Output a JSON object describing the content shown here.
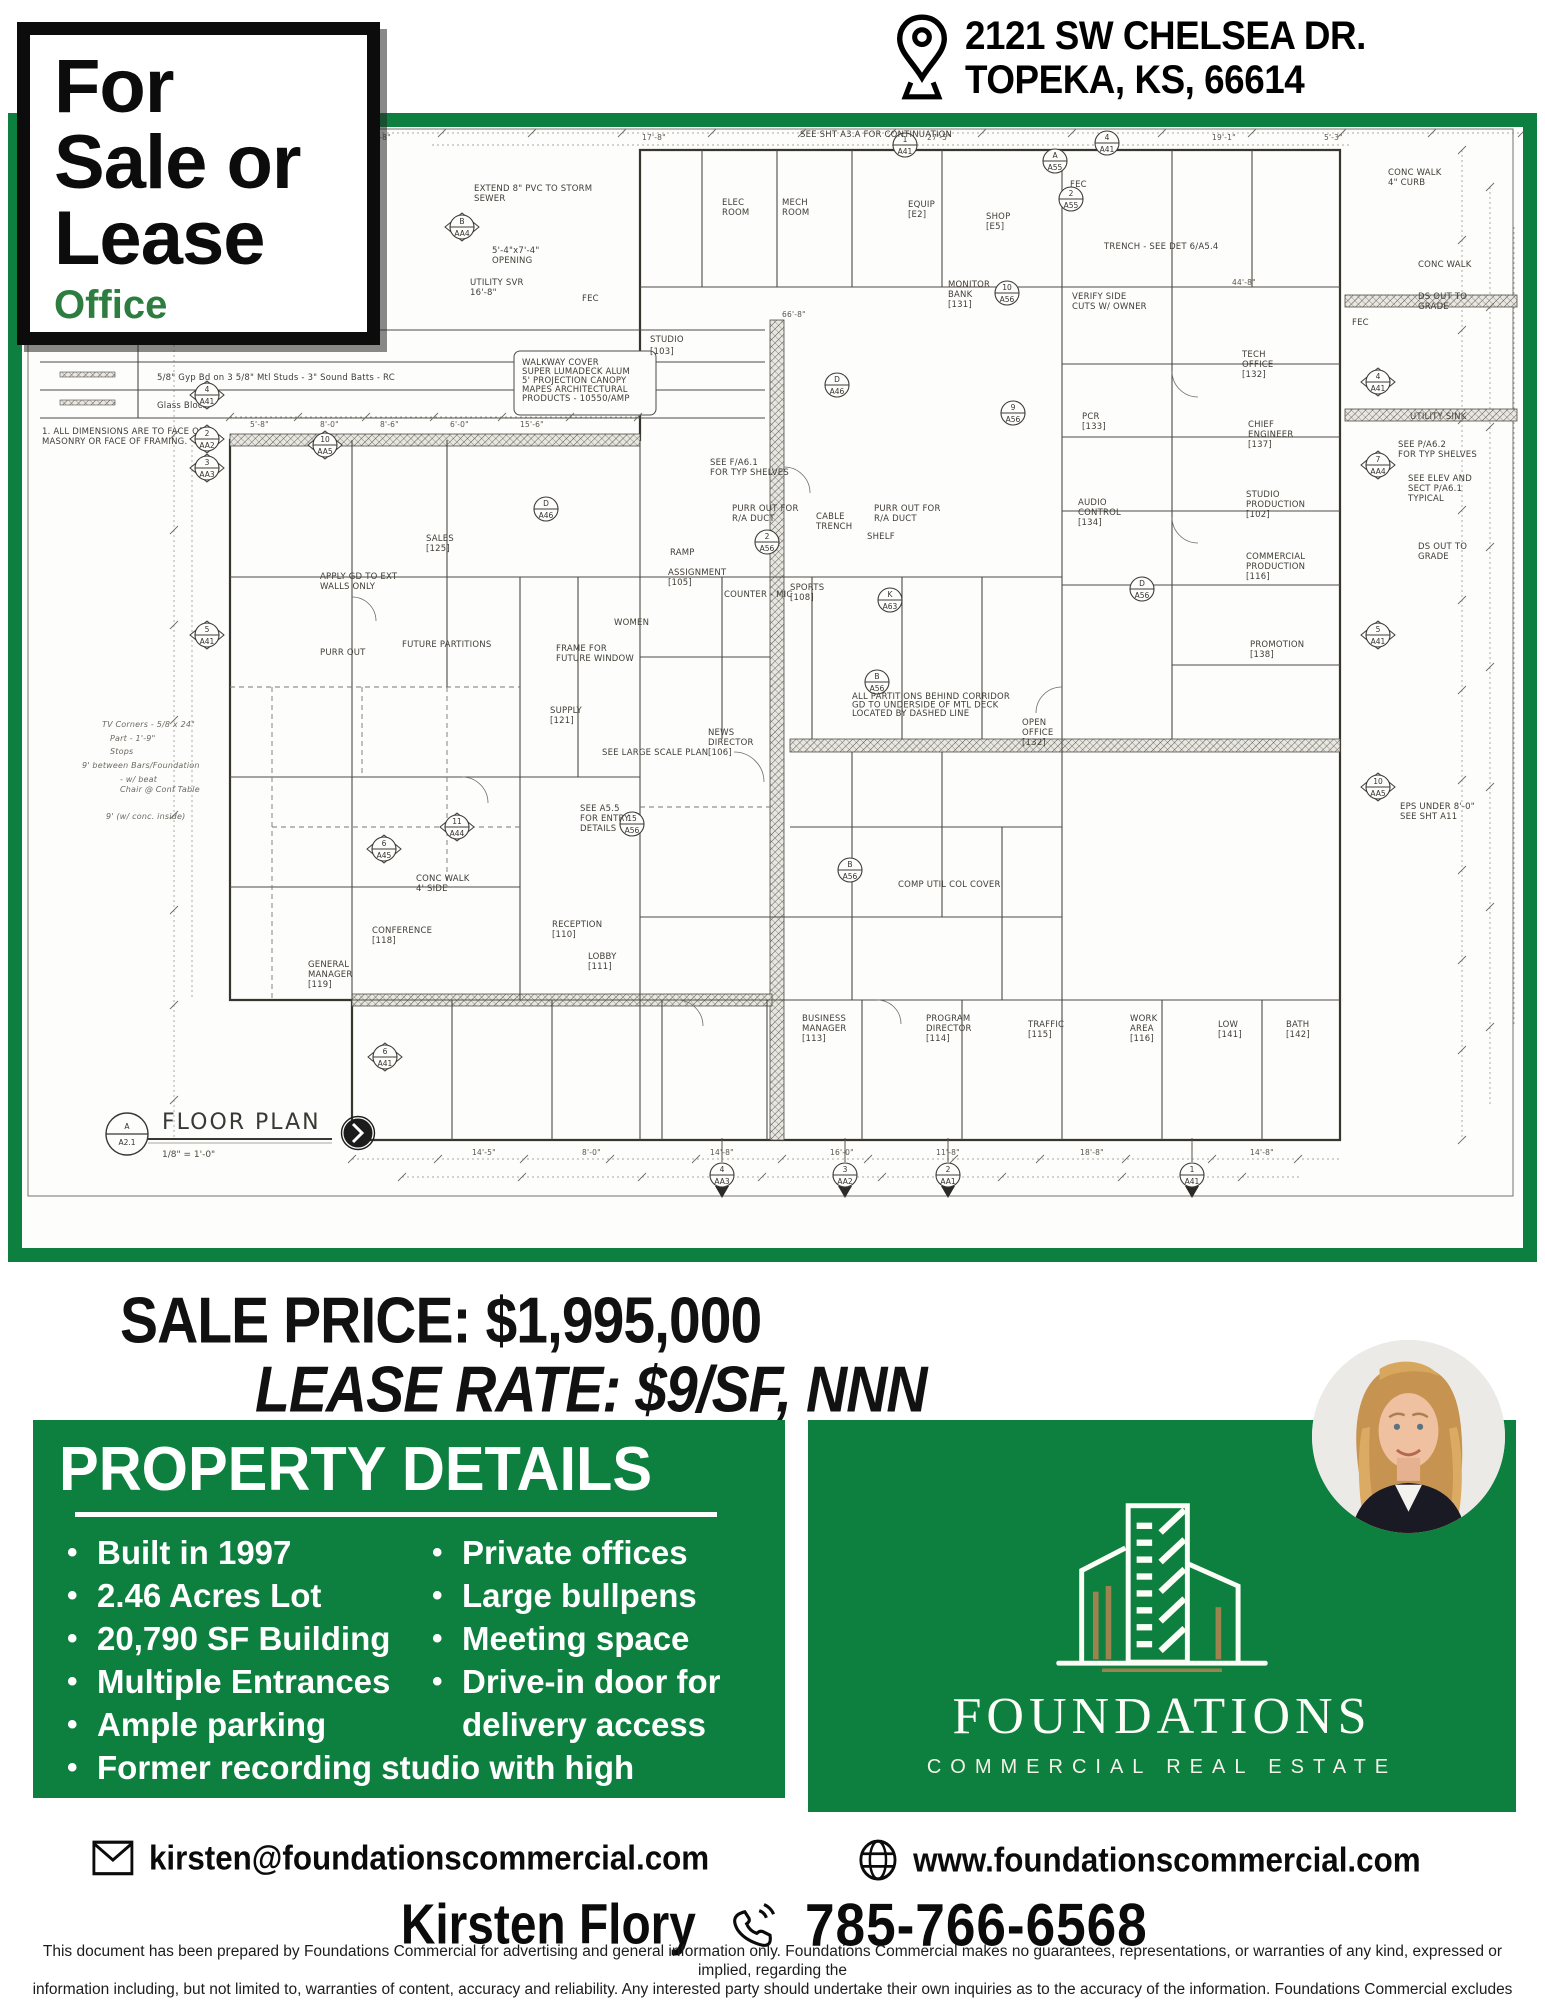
{
  "address": {
    "line1": "2121 SW CHELSEA DR.",
    "line2": "TOPEKA, KS, 66614"
  },
  "banner": {
    "line1": "For",
    "line2": "Sale or",
    "line3": "Lease",
    "subtitle": "Office"
  },
  "pricing": {
    "sale": "SALE PRICE: $1,995,000",
    "lease": "LEASE RATE: $9/SF, NNN"
  },
  "property_details": {
    "title": "PROPERTY DETAILS",
    "column1": [
      "Built in 1997",
      "2.46 Acres Lot",
      "20,790 SF Building",
      "Multiple Entrances",
      "Ample parking"
    ],
    "column2": [
      "Private offices",
      "Large bullpens",
      "Meeting space",
      "Drive-in door for delivery access"
    ],
    "full_width": [
      "Former recording studio with high ceilings"
    ]
  },
  "brand": {
    "name": "FOUNDATIONS",
    "tagline": "COMMERCIAL REAL ESTATE"
  },
  "contact": {
    "email": "kirsten@foundationscommercial.com",
    "website": "www.foundationscommercial.com",
    "agent": "Kirsten Flory",
    "phone": "785-766-6568"
  },
  "colors": {
    "green": "#0d7f3e",
    "office_green": "#2e7d40",
    "gold": "#9d8350"
  },
  "disclaimer": [
    "This document has been prepared by Foundations Commercial for advertising and general information only.  Foundations Commercial makes no guarantees, representations, or warranties of any kind, expressed or implied, regarding the",
    "information including, but not limited to, warranties of content, accuracy and reliability.  Any interested party should undertake their own inquiries as to the accuracy of the information.  Foundations Commercial excludes unequivocally all",
    "inferred or implied terms, conditions and warranties arising out of this document and excludes all liability for loss and damages arising there from.  This communication is not intended to cause or induce of any existing listing agreement."
  ],
  "plan": {
    "title": "FLOOR PLAN",
    "scale": "1/8\" = 1'-0\"",
    "ref_top": "A",
    "ref_bot": "A2.1",
    "legend1": "5/8\" Gyp Bd on 3 5/8\" Mtl Studs - 3\" Sound Batts - RC",
    "legend2": "Glass Block",
    "note1": "1. ALL DIMENSIONS ARE TO FACE OF",
    "note2": "MASONRY OR FACE OF FRAMING.",
    "labels": [
      {
        "t": "SEE SHT A3.A FOR CONTINUATION",
        "x": 778,
        "y": 10
      },
      {
        "t": "EXTEND 8\" PVC TO STORM\nSEWER",
        "x": 452,
        "y": 64
      },
      {
        "t": "CONC WALK\n4\" CURB",
        "x": 1366,
        "y": 48
      },
      {
        "t": "TRENCH - SEE DET 6/A5.4",
        "x": 1082,
        "y": 122
      },
      {
        "t": "5'-4\"x7'-4\"\nOPENING",
        "x": 470,
        "y": 126
      },
      {
        "t": "UTILITY SVR\n16'-8\"",
        "x": 448,
        "y": 158
      },
      {
        "t": "FEC",
        "x": 560,
        "y": 174
      },
      {
        "t": "FEC",
        "x": 1048,
        "y": 60
      },
      {
        "t": "FEC",
        "x": 1330,
        "y": 198
      },
      {
        "t": "ELEC\nROOM",
        "x": 700,
        "y": 78
      },
      {
        "t": "MECH\nROOM",
        "x": 760,
        "y": 78
      },
      {
        "t": "EQUIP\n[E2]",
        "x": 886,
        "y": 80
      },
      {
        "t": "SHOP\n[E5]",
        "x": 964,
        "y": 92
      },
      {
        "t": "VERIFY SIDE\nCUTS W/ OWNER",
        "x": 1050,
        "y": 172
      },
      {
        "t": "MONITOR\nBANK\n[131]",
        "x": 926,
        "y": 160
      },
      {
        "t": "TECH\nOFFICE\n[132]",
        "x": 1220,
        "y": 230
      },
      {
        "t": "STUDIO\n[103]",
        "x": 628,
        "y": 215,
        "s": 10.5
      },
      {
        "t": "PCR\n[133]",
        "x": 1060,
        "y": 292
      },
      {
        "t": "CHIEF\nENGINEER\n[137]",
        "x": 1226,
        "y": 300
      },
      {
        "t": "AUDIO\nCONTROL\n[134]",
        "x": 1056,
        "y": 378
      },
      {
        "t": "STUDIO\nPRODUCTION\n[102]",
        "x": 1224,
        "y": 370
      },
      {
        "t": "COMMERCIAL\nPRODUCTION\n[116]",
        "x": 1224,
        "y": 432
      },
      {
        "t": "PROMOTION\n[138]",
        "x": 1228,
        "y": 520
      },
      {
        "t": "CONC WALK",
        "x": 1396,
        "y": 140
      },
      {
        "t": "DS OUT TO\nGRADE",
        "x": 1396,
        "y": 172
      },
      {
        "t": "UTILITY SINK",
        "x": 1388,
        "y": 292
      },
      {
        "t": "SEE P/A6.2\nFOR TYP SHELVES",
        "x": 1376,
        "y": 320
      },
      {
        "t": "SEE ELEV AND\nSECT P/A6.1\nTYPICAL",
        "x": 1386,
        "y": 354
      },
      {
        "t": "DS OUT TO\nGRADE",
        "x": 1396,
        "y": 422
      },
      {
        "t": "EPS UNDER 8'-0\"\nSEE SHT A11",
        "x": 1378,
        "y": 682
      },
      {
        "t": "PURR OUT FOR\nR/A DUCT",
        "x": 710,
        "y": 384
      },
      {
        "t": "CABLE\nTRENCH",
        "x": 794,
        "y": 392
      },
      {
        "t": "PURR OUT FOR\nR/A DUCT",
        "x": 852,
        "y": 384
      },
      {
        "t": "SEE F/A6.1\nFOR TYP SHELVES",
        "x": 688,
        "y": 338
      },
      {
        "t": "RAMP",
        "x": 648,
        "y": 428
      },
      {
        "t": "ASSIGNMENT\n[105]",
        "x": 646,
        "y": 448
      },
      {
        "t": "COUNTER - MIC",
        "x": 702,
        "y": 470
      },
      {
        "t": "SPORTS\n[108]",
        "x": 768,
        "y": 463
      },
      {
        "t": "SHELF",
        "x": 845,
        "y": 412
      },
      {
        "t": "NEWS\nDIRECTOR\n[106]",
        "x": 686,
        "y": 608
      },
      {
        "t": "WOMEN",
        "x": 592,
        "y": 498
      },
      {
        "t": "SALES\n[125]",
        "x": 404,
        "y": 414
      },
      {
        "t": "APPLY GD TO EXT\nWALLS ONLY",
        "x": 298,
        "y": 452
      },
      {
        "t": "FUTURE PARTITIONS",
        "x": 380,
        "y": 520
      },
      {
        "t": "PURR OUT",
        "x": 298,
        "y": 528
      },
      {
        "t": "FRAME FOR\nFUTURE WINDOW",
        "x": 534,
        "y": 524
      },
      {
        "t": "SUPPLY\n[121]",
        "x": 528,
        "y": 586
      },
      {
        "t": "SEE LARGE SCALE PLAN",
        "x": 580,
        "y": 628
      },
      {
        "t": "SEE A5.5\nFOR ENTRY\nDETAILS",
        "x": 558,
        "y": 684
      },
      {
        "t": "RECEPTION\n[110]",
        "x": 530,
        "y": 800
      },
      {
        "t": "LOBBY\n[111]",
        "x": 566,
        "y": 832
      },
      {
        "t": "CONFERENCE\n[118]",
        "x": 350,
        "y": 806
      },
      {
        "t": "GENERAL\nMANAGER\n[119]",
        "x": 286,
        "y": 840
      },
      {
        "t": "OPEN\nOFFICE\n[132]",
        "x": 1000,
        "y": 598
      },
      {
        "t": "BUSINESS\nMANAGER\n[113]",
        "x": 780,
        "y": 894
      },
      {
        "t": "PROGRAM\nDIRECTOR\n[114]",
        "x": 904,
        "y": 894
      },
      {
        "t": "TRAFFIC\n[115]",
        "x": 1006,
        "y": 900
      },
      {
        "t": "WORK\nAREA\n[116]",
        "x": 1108,
        "y": 894
      },
      {
        "t": "LOW\n[141]",
        "x": 1196,
        "y": 900
      },
      {
        "t": "BATH\n[142]",
        "x": 1264,
        "y": 900
      },
      {
        "t": "CONC WALK\n4' SIDE",
        "x": 394,
        "y": 754
      },
      {
        "t": "COMP UTIL COL COVER",
        "x": 876,
        "y": 760
      },
      {
        "t": "ALL PARTITIONS BEHIND CORRIDOR\nGD TO UNDERSIDE OF MTL DECK\nLOCATED BY DASHED LINE",
        "x": 830,
        "y": 572,
        "s": 7
      },
      {
        "t": "WALKWAY COVER\nSUPER LUMADECK ALUM\n5' PROJECTION CANOPY\nMAPES ARCHITECTURAL\nPRODUCTS - 10550/AMP",
        "x": 500,
        "y": 238,
        "s": 7.5
      },
      {
        "t": "TV Corners - 5/8 x 24\"",
        "x": 80,
        "y": 600,
        "c": "hand"
      },
      {
        "t": "Part - 1'-9\"",
        "x": 88,
        "y": 614,
        "c": "hand"
      },
      {
        "t": "Stops",
        "x": 88,
        "y": 627,
        "c": "hand"
      },
      {
        "t": "9' between Bars/Foundation",
        "x": 60,
        "y": 641,
        "c": "hand"
      },
      {
        "t": "- w/ beat\nChair @ Conf Table",
        "x": 98,
        "y": 655,
        "c": "hand"
      },
      {
        "t": "9' (w/ conc. inside)",
        "x": 84,
        "y": 692,
        "c": "hand"
      },
      {
        "t": "66'-8\"",
        "x": 760,
        "y": 190,
        "c": "dim"
      },
      {
        "t": "44'-8\"",
        "x": 1210,
        "y": 158,
        "c": "dim"
      },
      {
        "t": "8'-8\"",
        "x": 350,
        "y": 13,
        "c": "dim"
      },
      {
        "t": "17'-8\"",
        "x": 620,
        "y": 13,
        "c": "dim"
      },
      {
        "t": "27'-5\"",
        "x": 905,
        "y": 13,
        "c": "dim"
      },
      {
        "t": "19'-1\"",
        "x": 1190,
        "y": 13,
        "c": "dim"
      },
      {
        "t": "5'-3\"",
        "x": 1302,
        "y": 13,
        "c": "dim"
      },
      {
        "t": "5'-8\"",
        "x": 228,
        "y": 300,
        "c": "dim"
      },
      {
        "t": "8'-0\"",
        "x": 298,
        "y": 300,
        "c": "dim"
      },
      {
        "t": "8'-6\"",
        "x": 358,
        "y": 300,
        "c": "dim"
      },
      {
        "t": "6'-0\"",
        "x": 428,
        "y": 300,
        "c": "dim"
      },
      {
        "t": "15'-6\"",
        "x": 498,
        "y": 300,
        "c": "dim"
      },
      {
        "t": "14'-5\"",
        "x": 450,
        "y": 1028,
        "c": "dim"
      },
      {
        "t": "8'-0\"",
        "x": 560,
        "y": 1028,
        "c": "dim"
      },
      {
        "t": "14'-8\"",
        "x": 688,
        "y": 1028,
        "c": "dim"
      },
      {
        "t": "16'-0\"",
        "x": 808,
        "y": 1028,
        "c": "dim"
      },
      {
        "t": "11'-8\"",
        "x": 914,
        "y": 1028,
        "c": "dim"
      },
      {
        "t": "18'-8\"",
        "x": 1058,
        "y": 1028,
        "c": "dim"
      },
      {
        "t": "14'-8\"",
        "x": 1228,
        "y": 1028,
        "c": "dim"
      }
    ],
    "markers": [
      {
        "t": "4",
        "b": "A41",
        "x": 185,
        "y": 268,
        "s": "d"
      },
      {
        "t": "2",
        "b": "AA2",
        "x": 185,
        "y": 312,
        "s": "d"
      },
      {
        "t": "3",
        "b": "AA3",
        "x": 185,
        "y": 341,
        "s": "d"
      },
      {
        "t": "5",
        "b": "A41",
        "x": 185,
        "y": 508,
        "s": "d"
      },
      {
        "t": "B",
        "b": "AA4",
        "x": 440,
        "y": 100,
        "s": "d"
      },
      {
        "t": "10",
        "b": "AA5",
        "x": 303,
        "y": 318,
        "s": "d"
      },
      {
        "t": "D",
        "b": "A46",
        "x": 524,
        "y": 382,
        "s": "c"
      },
      {
        "t": "1",
        "b": "A41",
        "x": 883,
        "y": 18,
        "s": "c"
      },
      {
        "t": "A",
        "b": "A55",
        "x": 1033,
        "y": 34,
        "s": "c"
      },
      {
        "t": "4",
        "b": "A41",
        "x": 1085,
        "y": 16,
        "s": "c"
      },
      {
        "t": "2",
        "b": "A55",
        "x": 1049,
        "y": 72,
        "s": "c"
      },
      {
        "t": "10",
        "b": "A56",
        "x": 985,
        "y": 166,
        "s": "c"
      },
      {
        "t": "9",
        "b": "A56",
        "x": 991,
        "y": 286,
        "s": "c"
      },
      {
        "t": "D",
        "b": "A46",
        "x": 815,
        "y": 258,
        "s": "c"
      },
      {
        "t": "D",
        "b": "A56",
        "x": 1120,
        "y": 462,
        "s": "c"
      },
      {
        "t": "2",
        "b": "A56",
        "x": 745,
        "y": 415,
        "s": "c"
      },
      {
        "t": "K",
        "b": "A63",
        "x": 868,
        "y": 473,
        "s": "c"
      },
      {
        "t": "B",
        "b": "A56",
        "x": 855,
        "y": 555,
        "s": "c"
      },
      {
        "t": "4",
        "b": "A41",
        "x": 1356,
        "y": 255,
        "s": "d"
      },
      {
        "t": "7",
        "b": "AA4",
        "x": 1356,
        "y": 338,
        "s": "d"
      },
      {
        "t": "5",
        "b": "A41",
        "x": 1356,
        "y": 508,
        "s": "d"
      },
      {
        "t": "10",
        "b": "AA5",
        "x": 1356,
        "y": 660,
        "s": "d"
      },
      {
        "t": "6",
        "b": "A45",
        "x": 362,
        "y": 722,
        "s": "d"
      },
      {
        "t": "11",
        "b": "A44",
        "x": 435,
        "y": 700,
        "s": "d"
      },
      {
        "t": "15",
        "b": "A56",
        "x": 610,
        "y": 697,
        "s": "c"
      },
      {
        "t": "B",
        "b": "A56",
        "x": 828,
        "y": 743,
        "s": "c"
      },
      {
        "t": "6",
        "b": "A41",
        "x": 363,
        "y": 930,
        "s": "d"
      },
      {
        "t": "4",
        "b": "AA3",
        "x": 700,
        "y": 1048,
        "s": "g"
      },
      {
        "t": "3",
        "b": "AA2",
        "x": 823,
        "y": 1048,
        "s": "g"
      },
      {
        "t": "2",
        "b": "AA1",
        "x": 926,
        "y": 1048,
        "s": "g"
      },
      {
        "t": "1",
        "b": "A41",
        "x": 1170,
        "y": 1048,
        "s": "g"
      }
    ]
  }
}
